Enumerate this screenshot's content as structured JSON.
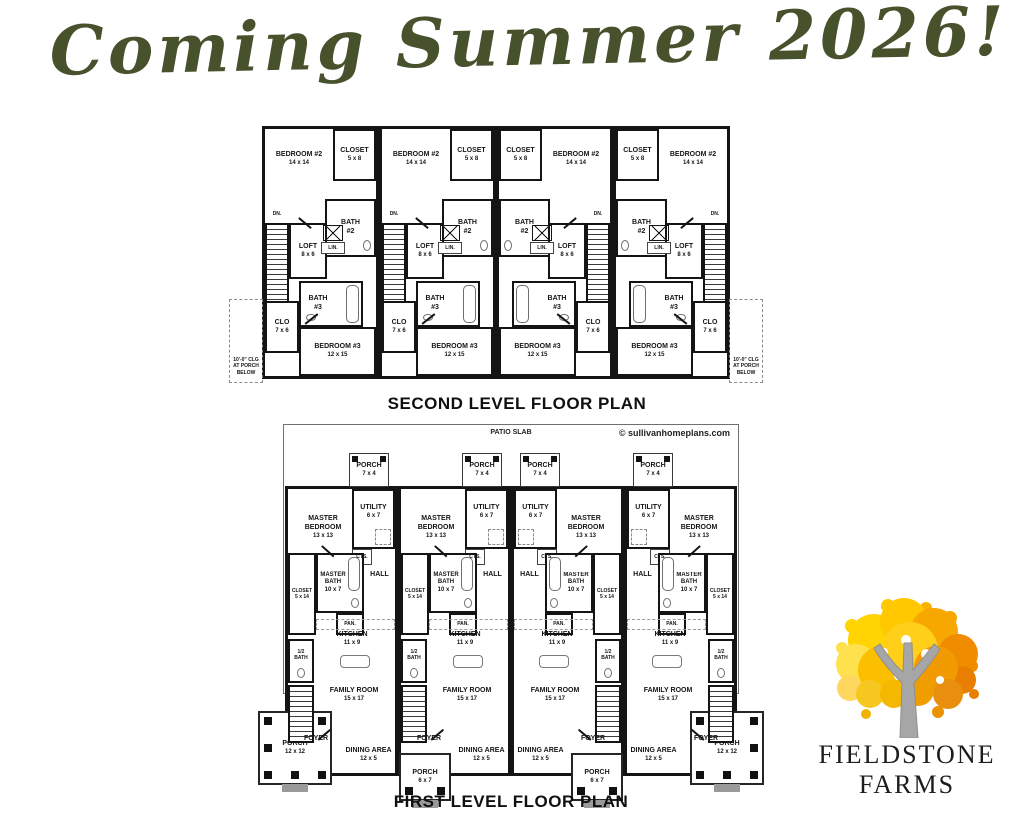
{
  "title": "Coming Summer 2026!",
  "colors": {
    "title_green": "#47512c",
    "plan_line": "#141414",
    "tree_yellow": "#ffd400",
    "tree_orange": "#ef8c00",
    "trunk_gray": "#a6a6a6"
  },
  "second_level": {
    "caption": "SECOND LEVEL FLOOR PLAN",
    "unit_count": 4,
    "rooms": {
      "bedroom2": {
        "name": "BEDROOM #2",
        "dims": "14 x 14"
      },
      "closet": {
        "name": "CLOSET",
        "dims": "5 x 8"
      },
      "bath2": {
        "name": "BATH",
        "num": "#2"
      },
      "loft": {
        "name": "LOFT",
        "dims": "8 x 6"
      },
      "bath3": {
        "name": "BATH",
        "num": "#3"
      },
      "linen": "LIN.",
      "stairs_down": "DN.",
      "clo": {
        "name": "CLO",
        "dims": "7 x 6"
      },
      "bedroom3": {
        "name": "BEDROOM #3",
        "dims": "12 x 15"
      }
    },
    "side_note": "10'-0\" CLG AT PORCH BELOW"
  },
  "first_level": {
    "caption": "FIRST LEVEL FLOOR PLAN",
    "patio_label": "PATIO SLAB",
    "copyright": "© sullivanhomeplans.com",
    "unit_count": 4,
    "rooms": {
      "rear_porch": {
        "name": "PORCH",
        "dims": "7 x 4"
      },
      "master_bedroom": {
        "name": "MASTER BEDROOM",
        "dims": "13 x 13"
      },
      "utility": {
        "name": "UTILITY",
        "dims": "6 x 7"
      },
      "cts": "CTS.",
      "closet": {
        "name": "CLOSET",
        "dims": "5 x 14"
      },
      "master_bath": {
        "name": "MASTER",
        "name2": "BATH",
        "dims": "10 x 7"
      },
      "hall": "HALL",
      "pantry": "PAN.",
      "kitchen": {
        "name": "KITCHEN",
        "dims": "11 x 9"
      },
      "half_bath": {
        "name": "1/2",
        "name2": "BATH"
      },
      "family_room": {
        "name": "FAMILY ROOM",
        "dims": "15 x 17"
      },
      "foyer": "FOYER",
      "dining": {
        "name": "DINING AREA",
        "dims": "12 x 5"
      },
      "front_porch_end": {
        "name": "PORCH",
        "dims": "12 x 12"
      },
      "front_porch_mid": {
        "name": "PORCH",
        "dims": "6 x 7"
      }
    }
  },
  "logo": {
    "line1": "FIELDSTONE",
    "line2": "FARMS"
  }
}
